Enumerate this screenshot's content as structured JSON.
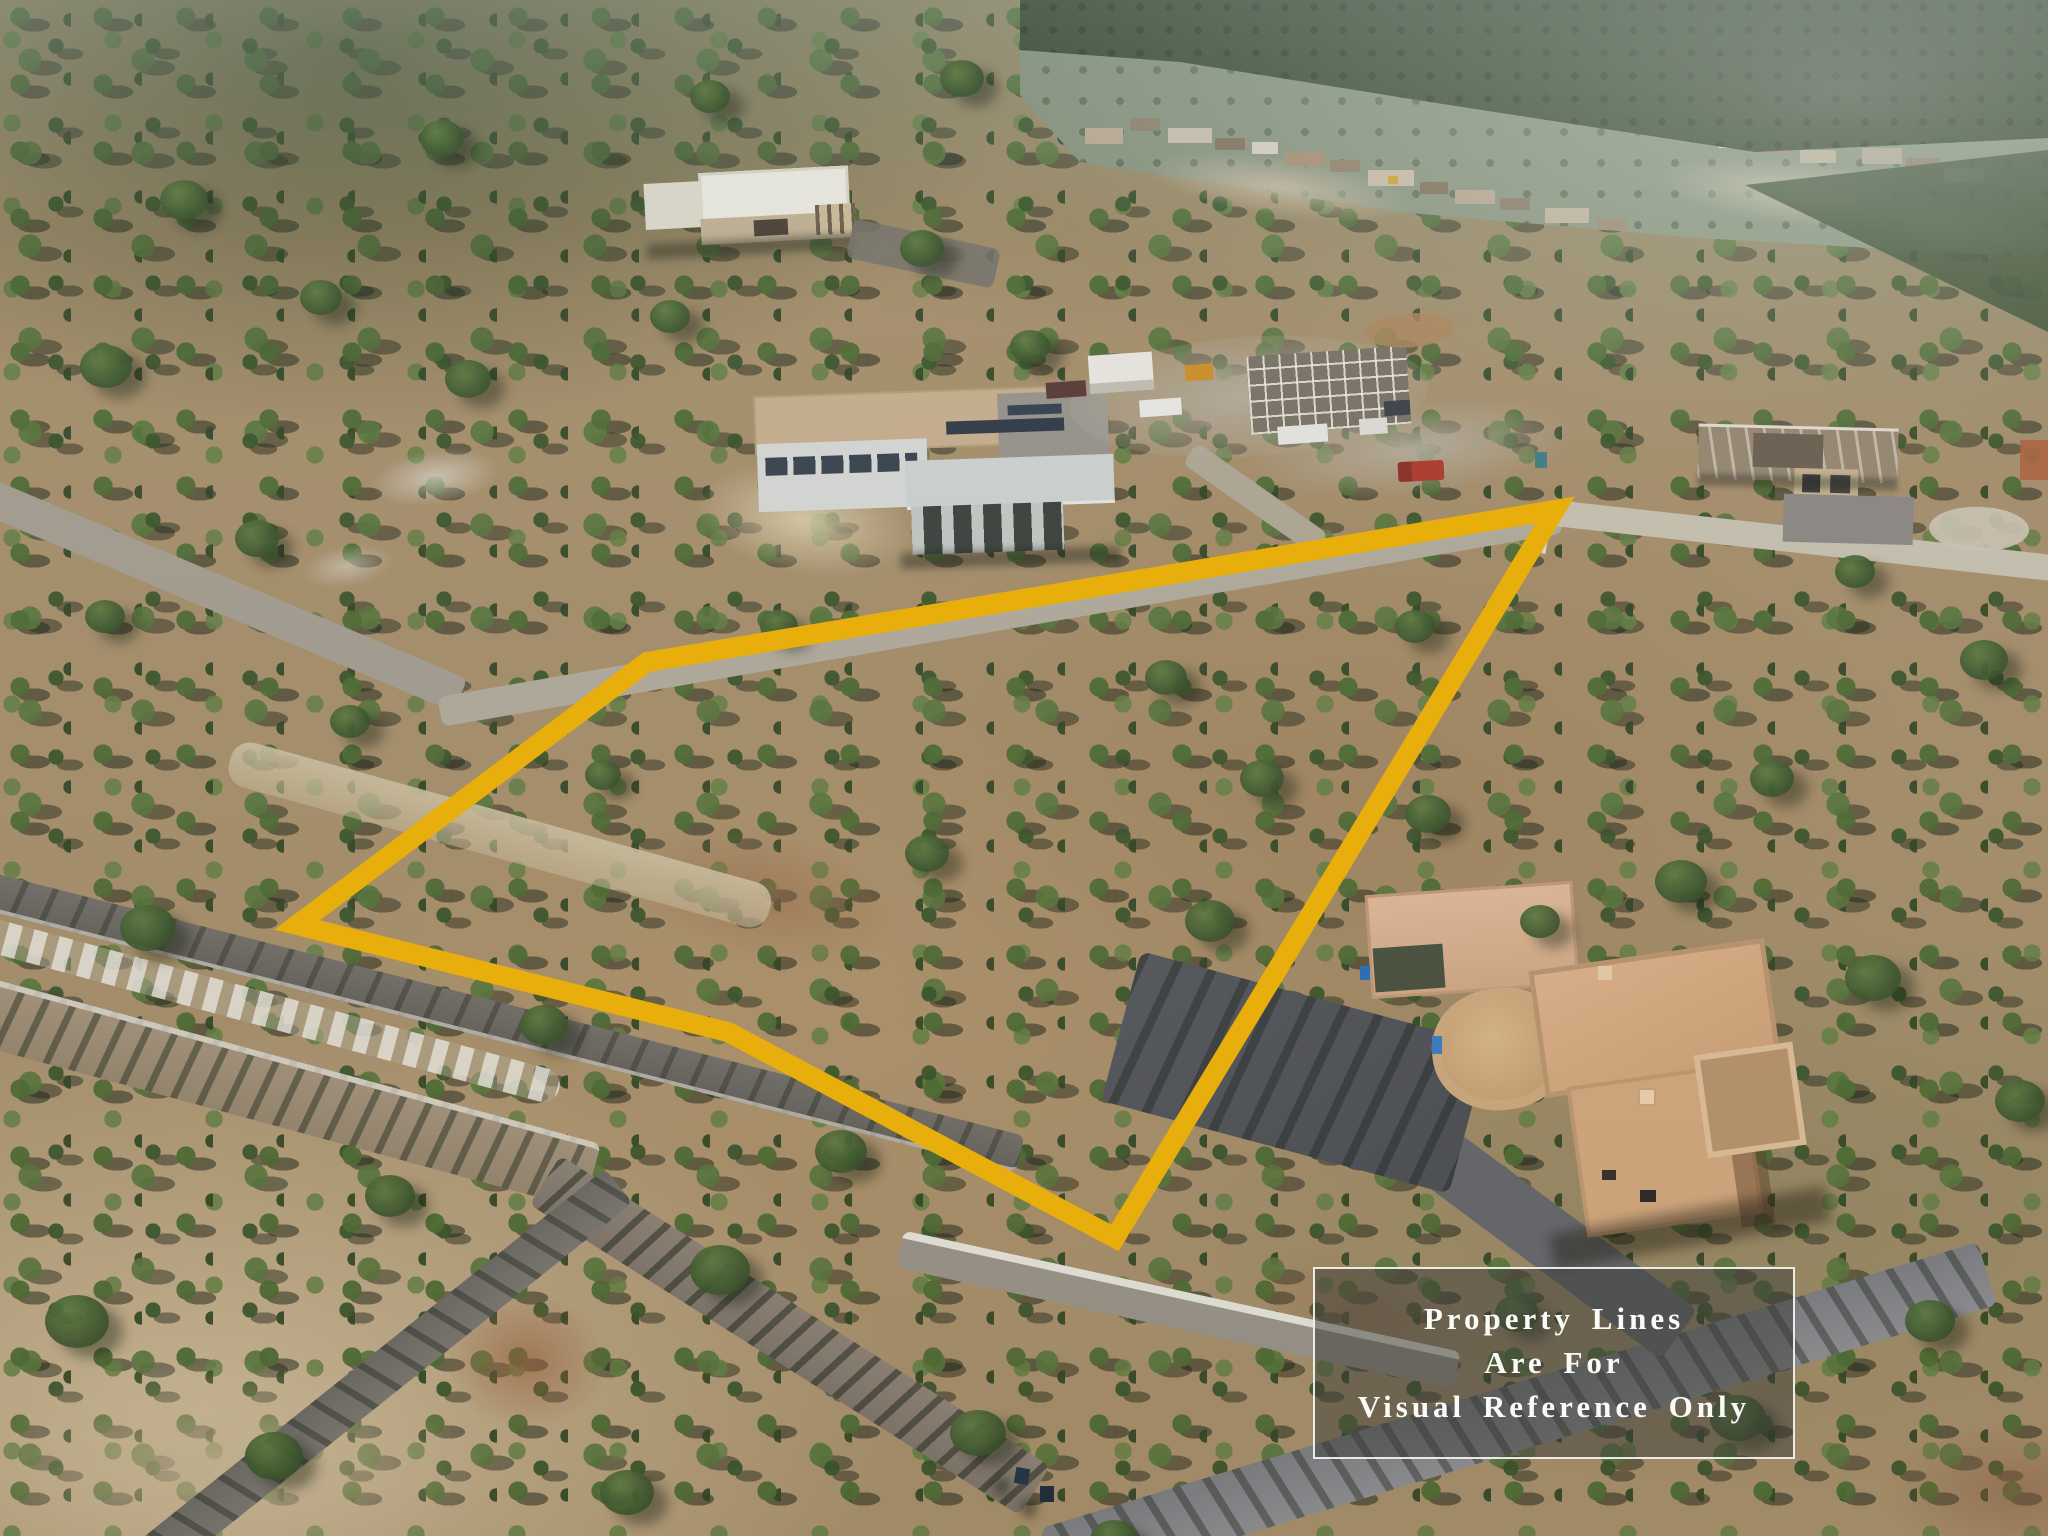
{
  "notice_box": {
    "line1": "Property Lines",
    "line2": "Are For",
    "line3": "Visual Reference Only",
    "text_color": "#FAFAF7",
    "background": "rgba(60,62,58,0.50)",
    "border_color": "rgba(250,250,246,0.90)"
  },
  "property_outline": {
    "color": "#E8AF0C",
    "stroke_width": 20,
    "points": "297,925 647,662 1555,510 1115,1238 728,1032"
  }
}
